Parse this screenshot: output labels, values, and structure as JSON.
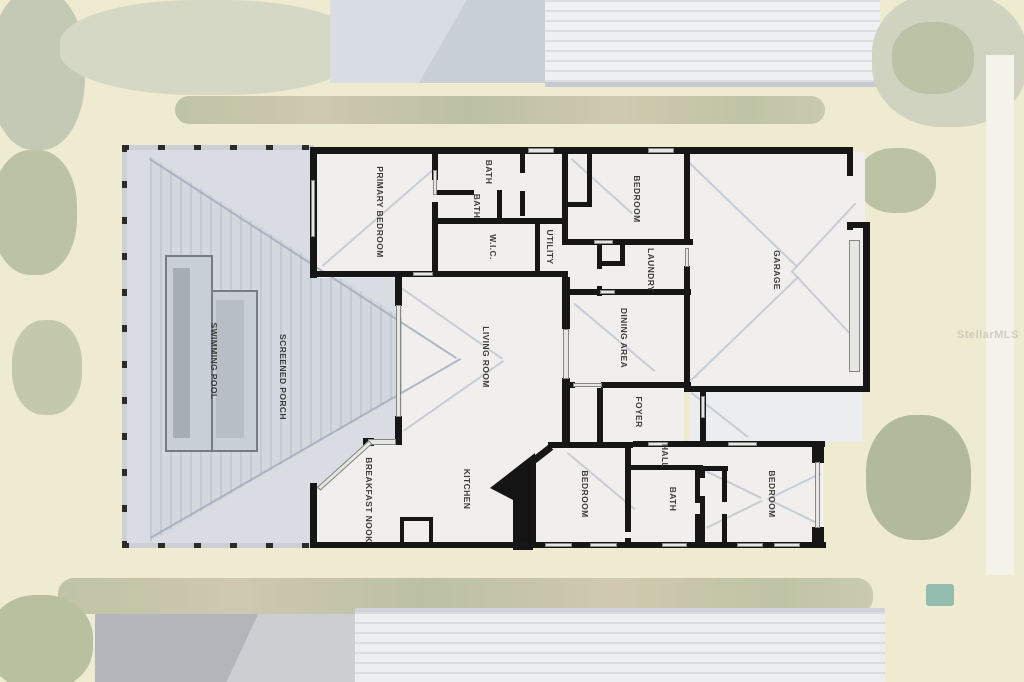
{
  "rooms": [
    {
      "name": "swimming-pool",
      "label": "SWIMMING POOL"
    },
    {
      "name": "screened-porch",
      "label": "SCREENED PORCH"
    },
    {
      "name": "primary-bedroom",
      "label": "PRIMARY BEDROOM"
    },
    {
      "name": "primary-bath",
      "label": "BATH"
    },
    {
      "name": "bath-2",
      "label": "BATH"
    },
    {
      "name": "walk-in-closet",
      "label": "W.I.C."
    },
    {
      "name": "utility",
      "label": "UTILITY"
    },
    {
      "name": "bedroom-top",
      "label": "BEDROOM"
    },
    {
      "name": "laundry",
      "label": "LAUNDRY"
    },
    {
      "name": "garage",
      "label": "GARAGE"
    },
    {
      "name": "dining-area",
      "label": "DINING AREA"
    },
    {
      "name": "living-room",
      "label": "LIVING ROOM"
    },
    {
      "name": "foyer",
      "label": "FOYER"
    },
    {
      "name": "hall",
      "label": "HALL"
    },
    {
      "name": "breakfast-nook",
      "label": "BREAKFAST NOOK"
    },
    {
      "name": "kitchen",
      "label": "KITCHEN"
    },
    {
      "name": "bedroom-middle",
      "label": "BEDROOM"
    },
    {
      "name": "bath-3",
      "label": "BATH"
    },
    {
      "name": "bedroom-right",
      "label": "BEDROOM"
    }
  ],
  "watermark": {
    "text": "StellarMLS"
  },
  "colors": {
    "wall": "#161616",
    "interior": "#f0efed",
    "porch": "#d9dde3",
    "pool": "#c9cfd7",
    "grass": "#e9e5c1"
  }
}
